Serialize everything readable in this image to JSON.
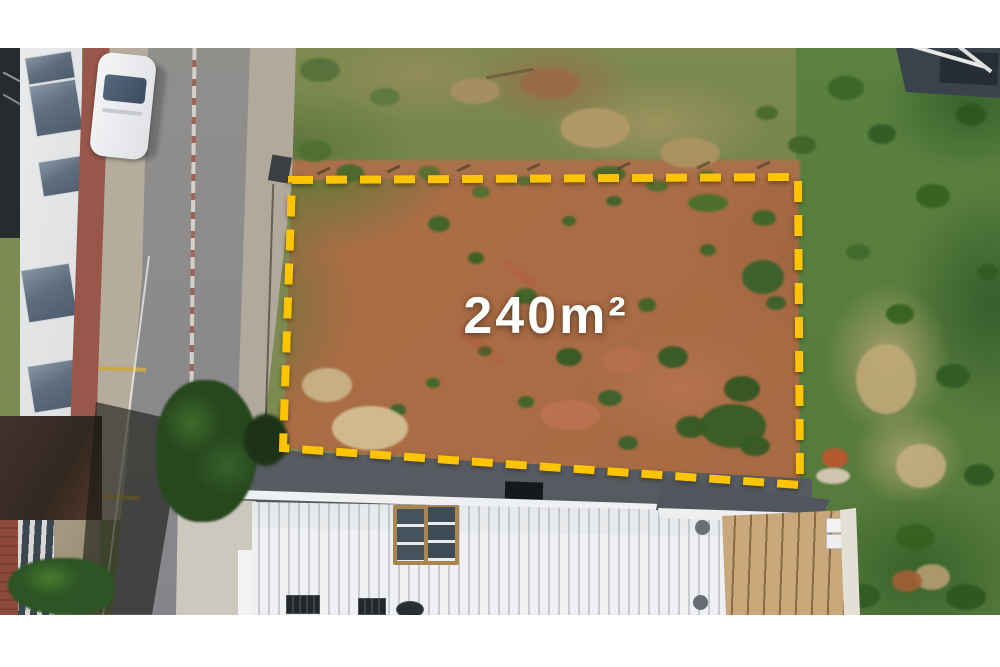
{
  "meta": {
    "scene": "aerial-drone-photo-of-land-plot-for-sale"
  },
  "overlay": {
    "area_label": "240m²",
    "boundary_color": "#FFC400",
    "label_color": "#FFFFFF",
    "letterbox_color": "#FFFFFF"
  }
}
